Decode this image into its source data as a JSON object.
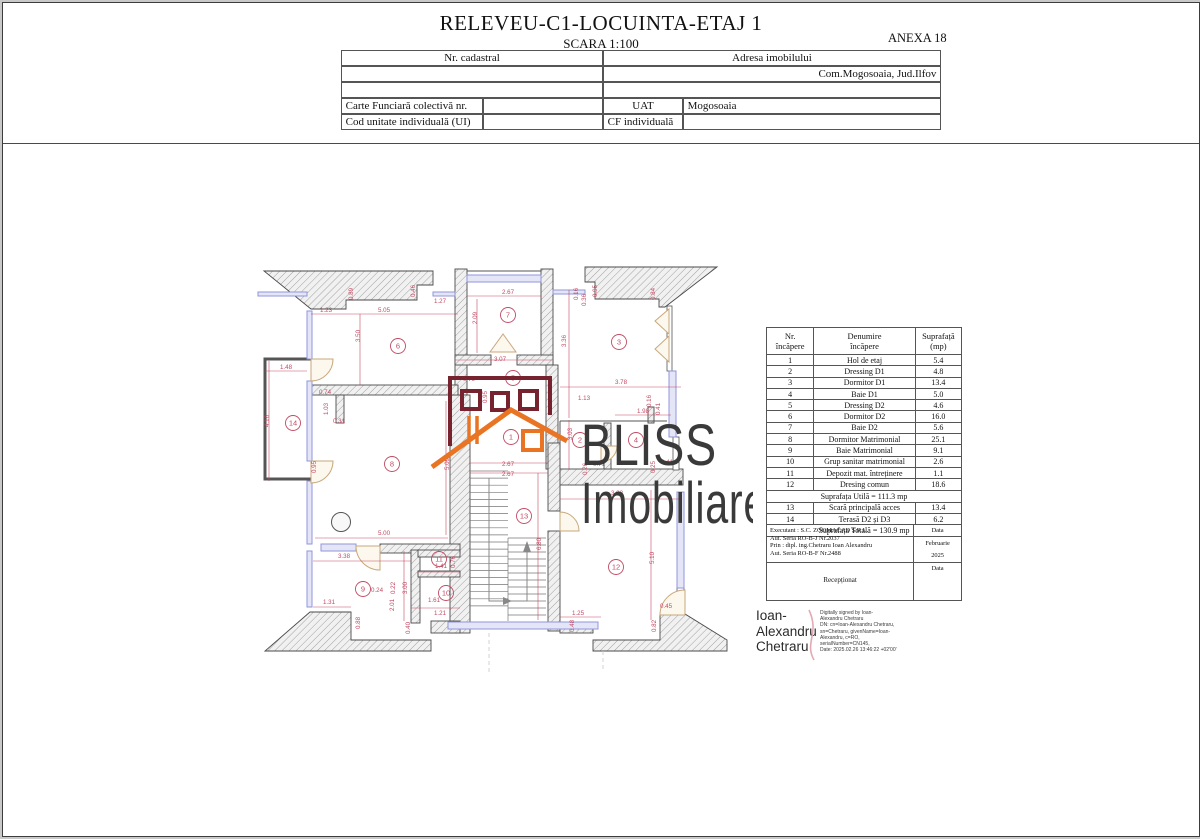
{
  "page": {
    "title": "RELEVEU-C1-LOCUINTA-ETAJ 1",
    "scale": "SCARA 1:100",
    "annex": "ANEXA 18"
  },
  "cadastral_table": {
    "nr_cadastral_label": "Nr. cadastral",
    "adresa_label": "Adresa imobilului",
    "adresa_value": "Com.Mogosoaia, Jud.Ilfov",
    "carte_funciara_label": "Carte Funciară colectivă nr.",
    "uat_label": "UAT",
    "uat_value": "Mogosoaia",
    "cod_unitate_label": "Cod unitate individuală (UI)",
    "cf_label": "CF individuală"
  },
  "room_table": {
    "header": {
      "col1_l1": "Nr.",
      "col1_l2": "încăpere",
      "col2_l1": "Denumire",
      "col2_l2": "încăpere",
      "col3_l1": "Suprafață",
      "col3_l2": "(mp)"
    },
    "rows": [
      [
        "1",
        "Hol de etaj",
        "5.4"
      ],
      [
        "2",
        "Dressing D1",
        "4.8"
      ],
      [
        "3",
        "Dormitor D1",
        "13.4"
      ],
      [
        "4",
        "Baie D1",
        "5.0"
      ],
      [
        "5",
        "Dressing D2",
        "4.6"
      ],
      [
        "6",
        "Dormitor D2",
        "16.0"
      ],
      [
        "7",
        "Baie D2",
        "5.6"
      ],
      [
        "8",
        "Dormitor Matrimonial",
        "25.1"
      ],
      [
        "9",
        "Baie Matrimonial",
        "9.1"
      ],
      [
        "10",
        "Grup sanitar matrimonial",
        "2.6"
      ],
      [
        "11",
        "Depozit mat. întreținere",
        "1.1"
      ],
      [
        "12",
        "Dresing comun",
        "18.6"
      ]
    ],
    "subtotal": "Suprafața Utilă = 111.3 mp",
    "rows2": [
      [
        "13",
        "Scară principală acces",
        "13.4"
      ],
      [
        "14",
        "Terasă D2 și D3",
        "6.2"
      ]
    ],
    "total": "Suprafața Totală = 130.9 mp"
  },
  "executant": {
    "lines": [
      "Executant : S.C. ZOOMACAD S.R.L.",
      "Aut. Seria RO-B-J Nr.2037",
      "Prin : dipl. ing.Chetraru Ioan Alexandru",
      "Aut. Seria RO-B-F Nr.2488"
    ],
    "data_label": "Data",
    "month": "Februarie",
    "year": "2025",
    "receptionat": "Recepționat",
    "data_label2": "Data"
  },
  "signature": {
    "name_lines": [
      "Ioan-",
      "Alexandru",
      "Chetraru"
    ],
    "details_lines": [
      "Digitally signed by Ioan-",
      "Alexandru Chetraru",
      "DN: cn=Ioan-Alexandru Chetraru,",
      "sn=Chetraru, givenName=Ioan-",
      "Alexandru, c=RO,",
      "serialNumber=CN145,",
      "Date: 2025.02.26 13:46:22 +02'00'"
    ]
  },
  "watermark": {
    "line1": "BLISS",
    "line2": "Imobiliare"
  },
  "colors": {
    "dimension": "#c34a63",
    "window": "#8f96d8",
    "door": "#c8a87c",
    "logo_maroon": "#76232f",
    "logo_orange": "#e87424",
    "watermark_text": "#3a3a3a"
  },
  "plan": {
    "rooms": [
      {
        "n": "1",
        "x": 508,
        "y": 434
      },
      {
        "n": "2",
        "x": 577,
        "y": 437
      },
      {
        "n": "3",
        "x": 616,
        "y": 339
      },
      {
        "n": "4",
        "x": 633,
        "y": 437
      },
      {
        "n": "5",
        "x": 510,
        "y": 375
      },
      {
        "n": "6",
        "x": 395,
        "y": 343
      },
      {
        "n": "7",
        "x": 505,
        "y": 312
      },
      {
        "n": "8",
        "x": 389,
        "y": 461
      },
      {
        "n": "9",
        "x": 360,
        "y": 586
      },
      {
        "n": "10",
        "x": 443,
        "y": 590
      },
      {
        "n": "11",
        "x": 436,
        "y": 556
      },
      {
        "n": "12",
        "x": 613,
        "y": 564
      },
      {
        "n": "13",
        "x": 521,
        "y": 513
      },
      {
        "n": "14",
        "x": 290,
        "y": 420
      }
    ],
    "dims": [
      {
        "t": "1.23",
        "x": 323,
        "y": 309
      },
      {
        "t": "5.05",
        "x": 381,
        "y": 309
      },
      {
        "t": "0.89",
        "x": 350,
        "y": 291,
        "r": 90
      },
      {
        "t": "3.50",
        "x": 357,
        "y": 333,
        "r": 90
      },
      {
        "t": "0.46",
        "x": 412,
        "y": 288,
        "r": 90
      },
      {
        "t": "1.27",
        "x": 437,
        "y": 300
      },
      {
        "t": "2.67",
        "x": 505,
        "y": 291
      },
      {
        "t": "2.09",
        "x": 474,
        "y": 315,
        "r": 90
      },
      {
        "t": "3.07",
        "x": 497,
        "y": 358
      },
      {
        "t": "0.16",
        "x": 575,
        "y": 291,
        "r": 90
      },
      {
        "t": "0.36",
        "x": 583,
        "y": 297,
        "r": 90
      },
      {
        "t": "0.95",
        "x": 594,
        "y": 288,
        "r": 90
      },
      {
        "t": "0.84",
        "x": 652,
        "y": 291,
        "r": 90
      },
      {
        "t": "3.36",
        "x": 563,
        "y": 338,
        "r": 90
      },
      {
        "t": "1.48",
        "x": 283,
        "y": 366
      },
      {
        "t": "4.16",
        "x": 266,
        "y": 418,
        "r": 90
      },
      {
        "t": "0.74",
        "x": 322,
        "y": 391
      },
      {
        "t": "1.03",
        "x": 325,
        "y": 406,
        "r": 90
      },
      {
        "t": "0.31",
        "x": 336,
        "y": 420
      },
      {
        "t": "0.79",
        "x": 466,
        "y": 378
      },
      {
        "t": "0.95",
        "x": 484,
        "y": 394,
        "r": 90
      },
      {
        "t": "3.03",
        "x": 569,
        "y": 431,
        "r": 90
      },
      {
        "t": "5.09",
        "x": 446,
        "y": 461,
        "r": 90
      },
      {
        "t": "0.95",
        "x": 313,
        "y": 464,
        "r": 90
      },
      {
        "t": "2.67",
        "x": 505,
        "y": 463
      },
      {
        "t": "2.67",
        "x": 505,
        "y": 473
      },
      {
        "t": "6.80",
        "x": 538,
        "y": 541,
        "r": 90
      },
      {
        "t": "1.25",
        "x": 575,
        "y": 612
      },
      {
        "t": "3.78",
        "x": 618,
        "y": 381
      },
      {
        "t": "1.13",
        "x": 581,
        "y": 397
      },
      {
        "t": "0.16",
        "x": 648,
        "y": 398,
        "r": 90
      },
      {
        "t": "0.41",
        "x": 657,
        "y": 406,
        "r": 90
      },
      {
        "t": "1.98",
        "x": 640,
        "y": 410
      },
      {
        "t": "0.71",
        "x": 596,
        "y": 463
      },
      {
        "t": "0.26",
        "x": 584,
        "y": 466,
        "r": 90
      },
      {
        "t": "0.25",
        "x": 652,
        "y": 464,
        "r": 90
      },
      {
        "t": "0.41",
        "x": 664,
        "y": 461
      },
      {
        "t": "3.83",
        "x": 614,
        "y": 492
      },
      {
        "t": "5.10",
        "x": 651,
        "y": 555,
        "r": 90
      },
      {
        "t": "0.45",
        "x": 663,
        "y": 605
      },
      {
        "t": "0.82",
        "x": 653,
        "y": 623,
        "r": 90
      },
      {
        "t": "0.48",
        "x": 571,
        "y": 623,
        "r": 90
      },
      {
        "t": "5.00",
        "x": 381,
        "y": 532
      },
      {
        "t": "3.38",
        "x": 341,
        "y": 555
      },
      {
        "t": "3.00",
        "x": 404,
        "y": 585,
        "r": 90
      },
      {
        "t": "1.31",
        "x": 326,
        "y": 601
      },
      {
        "t": "0.88",
        "x": 357,
        "y": 620,
        "r": 90
      },
      {
        "t": "1.41",
        "x": 438,
        "y": 565
      },
      {
        "t": "0.76",
        "x": 452,
        "y": 559,
        "r": 90
      },
      {
        "t": "0.24",
        "x": 374,
        "y": 589
      },
      {
        "t": "0.22",
        "x": 392,
        "y": 585,
        "r": 90
      },
      {
        "t": "2.01",
        "x": 391,
        "y": 602,
        "r": 90
      },
      {
        "t": "1.61",
        "x": 431,
        "y": 599
      },
      {
        "t": "1.21",
        "x": 437,
        "y": 612
      },
      {
        "t": "0.40",
        "x": 407,
        "y": 625,
        "r": 90
      }
    ]
  }
}
